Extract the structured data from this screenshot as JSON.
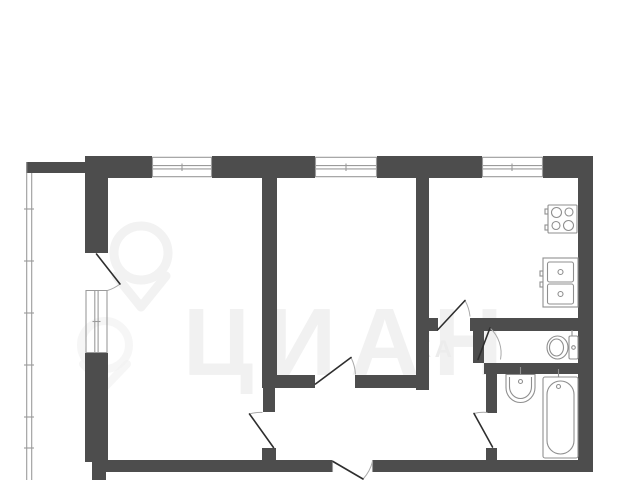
{
  "plan": {
    "type": "apartment-floor-plan",
    "watermark": {
      "big_text": "ЦИАН",
      "small_text": "КА",
      "pin_icon": "location-pin-icon"
    },
    "colors": {
      "wall": "#4d4d4d",
      "line": "#9b9b9b",
      "leaf": "#2e2e2e",
      "arc": "#a9a9a9",
      "fixture": "#8f8f8f",
      "watermark_big": "#f1f1f1",
      "watermark_pin": "#f2f2f2",
      "background": "#ffffff"
    },
    "rooms": [
      "living-room",
      "bedroom",
      "kitchen",
      "hallway",
      "toilet",
      "bathroom",
      "balcony"
    ],
    "window_count": 4,
    "icons": [
      "stove-icon",
      "kitchen-sink-icon",
      "toilet-icon",
      "washbasin-icon",
      "bathtub-icon",
      "location-pin-icon"
    ]
  }
}
